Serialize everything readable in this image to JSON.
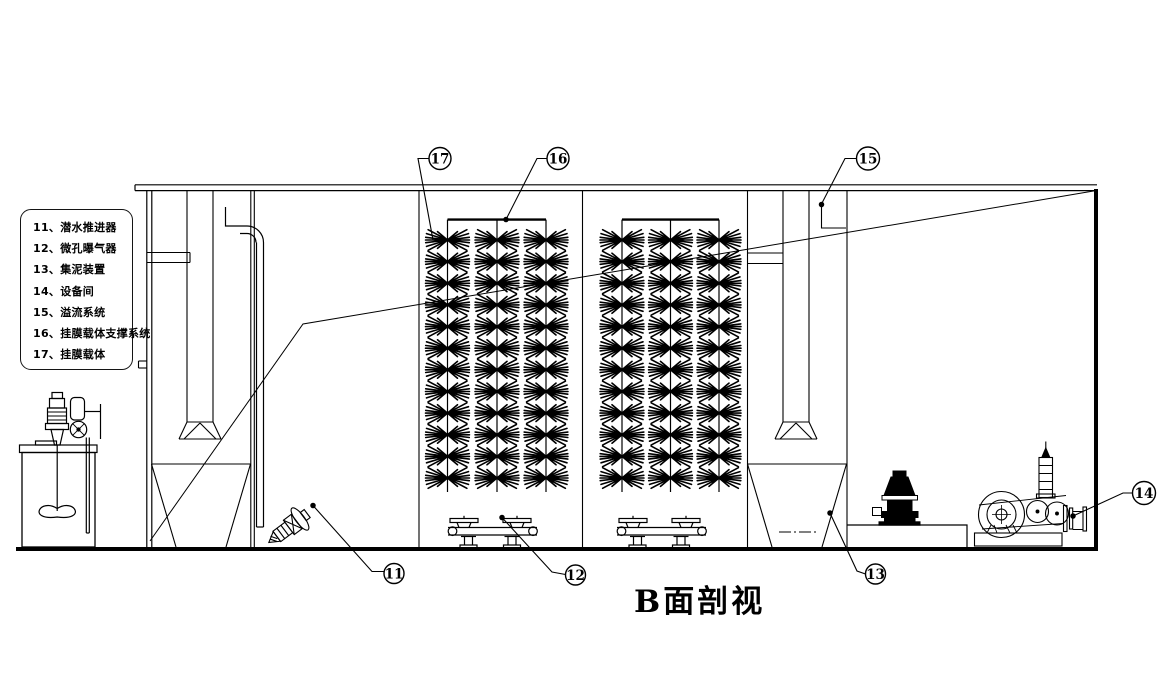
{
  "title": "B面剖视",
  "legend": {
    "items": [
      {
        "label": "11、潜水推进器"
      },
      {
        "label": "12、微孔曝气器"
      },
      {
        "label": "13、集泥装置"
      },
      {
        "label": "14、设备间"
      },
      {
        "label": "15、溢流系统"
      },
      {
        "label": "16、挂膜载体支撑系统"
      },
      {
        "label": "17、挂膜载体"
      }
    ]
  },
  "callouts": [
    {
      "number": "17"
    },
    {
      "number": "16"
    },
    {
      "number": "15"
    },
    {
      "number": "11"
    },
    {
      "number": "12"
    },
    {
      "number": "13"
    },
    {
      "number": "14"
    }
  ],
  "colors": {
    "line": "#000000",
    "background": "#ffffff"
  }
}
